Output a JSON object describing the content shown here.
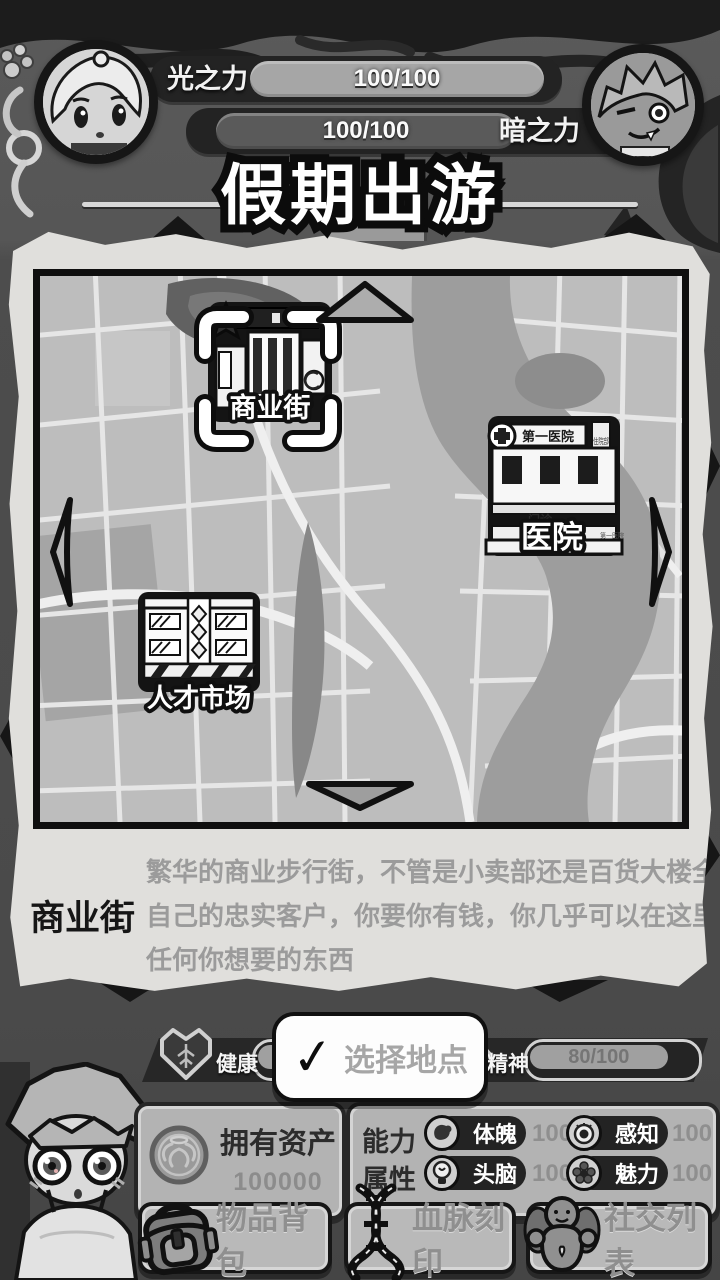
{
  "header": {
    "title": "假期出游",
    "light_power": {
      "label": "光之力",
      "value": "100/100"
    },
    "dark_power": {
      "label": "暗之力",
      "value": "100/100"
    }
  },
  "map": {
    "locations": [
      {
        "name": "商业街",
        "selected": true
      },
      {
        "name": "医院",
        "sign_top": "第一医院",
        "sign_door": "门诊",
        "sign_side": "住院部",
        "sign_small": "第一医院"
      },
      {
        "name": "人才市场"
      }
    ]
  },
  "description": {
    "title": "商业街",
    "lines": [
      "繁华的商业步行街，不管是小卖部还是百货大楼全都有",
      "自己的忠实客户，你要你有钱，你几乎可以在这里买到",
      "任何你想要的东西"
    ]
  },
  "action": {
    "check_glyph": "✓",
    "label": "选择地点"
  },
  "status": {
    "health": {
      "label": "健康"
    },
    "spirit": {
      "label": "精神",
      "value": "80/100"
    }
  },
  "assets": {
    "label": "拥有资产",
    "value": "100000"
  },
  "attributes": {
    "label_line1": "能力",
    "label_line2": "属性",
    "items": [
      {
        "name": "体魄",
        "value": "100"
      },
      {
        "name": "感知",
        "value": "100"
      },
      {
        "name": "头脑",
        "value": "100"
      },
      {
        "name": "魅力",
        "value": "100"
      }
    ]
  },
  "menu": {
    "items": [
      {
        "label": "物品背包"
      },
      {
        "label": "血脉刻印"
      },
      {
        "label": "社交列表"
      }
    ]
  }
}
